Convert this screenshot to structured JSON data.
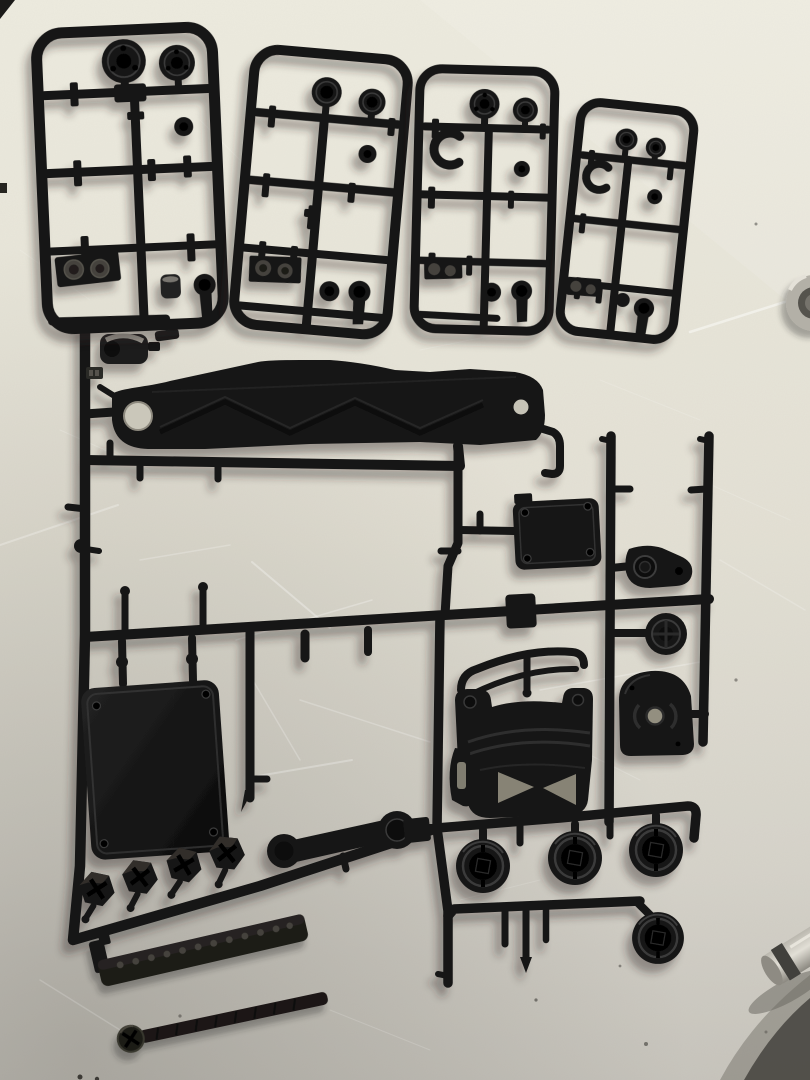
{
  "meta": {
    "kind": "photograph",
    "subject": "Black plastic model-kit sprues (parts trees) for an RC car kit laid on a scratched off-white workbench",
    "camera": "overhead, slight tilt, soft light from upper right"
  },
  "colors": {
    "bg-top": "#edebdf",
    "bg-mid": "#e3e0d4",
    "bg-low": "#d6d3ca",
    "bg-bottom": "#c7c4bc",
    "plastic": "#151515",
    "plastic-2": "#242424",
    "plastic-edge": "#3a3a3a",
    "hole-dark": "#060606",
    "hole-light": "#cac7ba",
    "through-gray": "#938f80",
    "emboss-gray": "#45423e",
    "metal-silver": "#bab7ae",
    "metal-dark": "#413f3b",
    "scratch": "#ffffff",
    "speck": "#3c3a35",
    "corner-shadow": "#4a4842"
  },
  "scene": {
    "surface": "off-white scratched work surface, darker toward bottom",
    "parts": [
      {
        "name": "parts-tree-a",
        "description": "small sprue: two round hub discs, washer, clips, embossed gear plate, ball-link rod end"
      },
      {
        "name": "parts-tree-b",
        "description": "small sprue: two round hub discs, ring, gear plate, ball cup, rod end"
      },
      {
        "name": "parts-tree-c",
        "description": "small sprue with open C-ring, two discs, ring, rod end"
      },
      {
        "name": "parts-tree-d",
        "description": "small tilted sprue with open C-ring, two discs, ball cup, rod end"
      },
      {
        "name": "main-parts-tree",
        "description": "large sprue holding chassis parts"
      },
      {
        "name": "chassis-brace-plate",
        "description": "long flat brace with end holes and X ribs"
      },
      {
        "name": "cover-plate-small",
        "description": "small rectangular cover with corner holes"
      },
      {
        "name": "servo-mount-teardrop",
        "description": "teardrop mount with large and small holes"
      },
      {
        "name": "servo-saver-disc",
        "description": "round servo saver"
      },
      {
        "name": "gear-cover-housing",
        "description": "D-shaped gear cover with center hole"
      },
      {
        "name": "gearbox-housing",
        "description": "gearbox body with eared top, straps and X-braced base"
      },
      {
        "name": "roll-bar",
        "description": "curved bar above gearbox"
      },
      {
        "name": "battery-cover-plate",
        "description": "large rounded rectangular plate with corner holes"
      },
      {
        "name": "hex-wheel-hubs",
        "count": 4,
        "description": "row of hexagonal hubs on diagonal runner"
      },
      {
        "name": "drive-drums",
        "count": 4,
        "description": "round drum hubs with square center holes"
      },
      {
        "name": "steering-link",
        "description": "double-eyelet link bar"
      },
      {
        "name": "ladder-rail-beam",
        "description": "loose perforated beam, tilted"
      },
      {
        "name": "long-screw",
        "description": "loose long screw with phillips head"
      },
      {
        "name": "metal-ring",
        "description": "chrome ring partially visible at right edge"
      },
      {
        "name": "metal-cylinder",
        "description": "chrome cylinder partially visible at lower right edge"
      }
    ]
  }
}
